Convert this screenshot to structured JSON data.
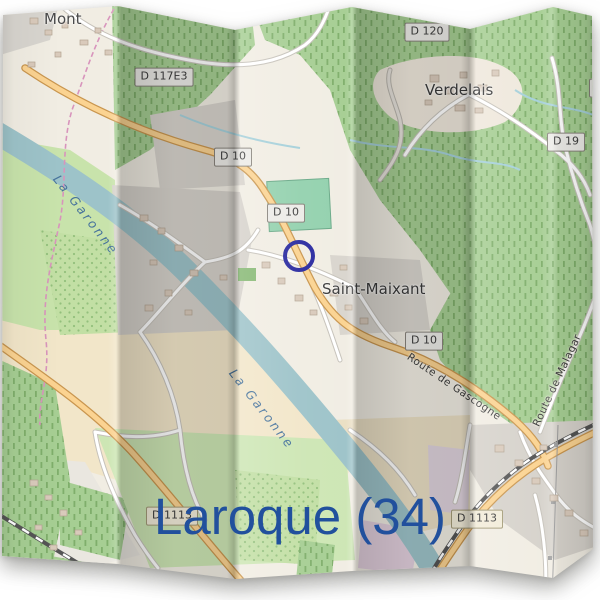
{
  "title": {
    "text": "Laroque (34)",
    "color": "#21509d"
  },
  "marker": {
    "type": "circle-outline",
    "color": "#2a2aa0"
  },
  "map": {
    "style": "openstreetmap-folded-paper",
    "places": [
      {
        "id": "mont",
        "label": "Mont"
      },
      {
        "id": "verdelais",
        "label": "Verdelais"
      },
      {
        "id": "saint-maixant",
        "label": "Saint-Maixant"
      }
    ],
    "water_labels": [
      {
        "id": "la-garonne-upper",
        "label": "La Garonne"
      },
      {
        "id": "la-garonne-lower",
        "label": "La Garonne"
      }
    ],
    "road_labels": [
      {
        "id": "route-de-gascogne",
        "label": "Route de Gascogne"
      },
      {
        "id": "route-de-malagar",
        "label": "Route de Malagar"
      }
    ],
    "badges": [
      {
        "id": "d117e3",
        "label": "D 117E3"
      },
      {
        "id": "d120",
        "label": "D 120"
      },
      {
        "id": "d10-north",
        "label": "D 10"
      },
      {
        "id": "d10-mid",
        "label": "D 10"
      },
      {
        "id": "d10-south",
        "label": "D 10"
      },
      {
        "id": "d19",
        "label": "D 19"
      },
      {
        "id": "d19-edge",
        "label": "D 19"
      },
      {
        "id": "d1113-west",
        "label": "D 1113"
      },
      {
        "id": "d1113-east",
        "label": "D 1113"
      }
    ],
    "colors": {
      "water": "#9dc3c9",
      "forest": "#a6ce93",
      "road_major": "#fbd391",
      "residential": "#d6d2cb",
      "farmland": "#f2e6c9"
    }
  }
}
